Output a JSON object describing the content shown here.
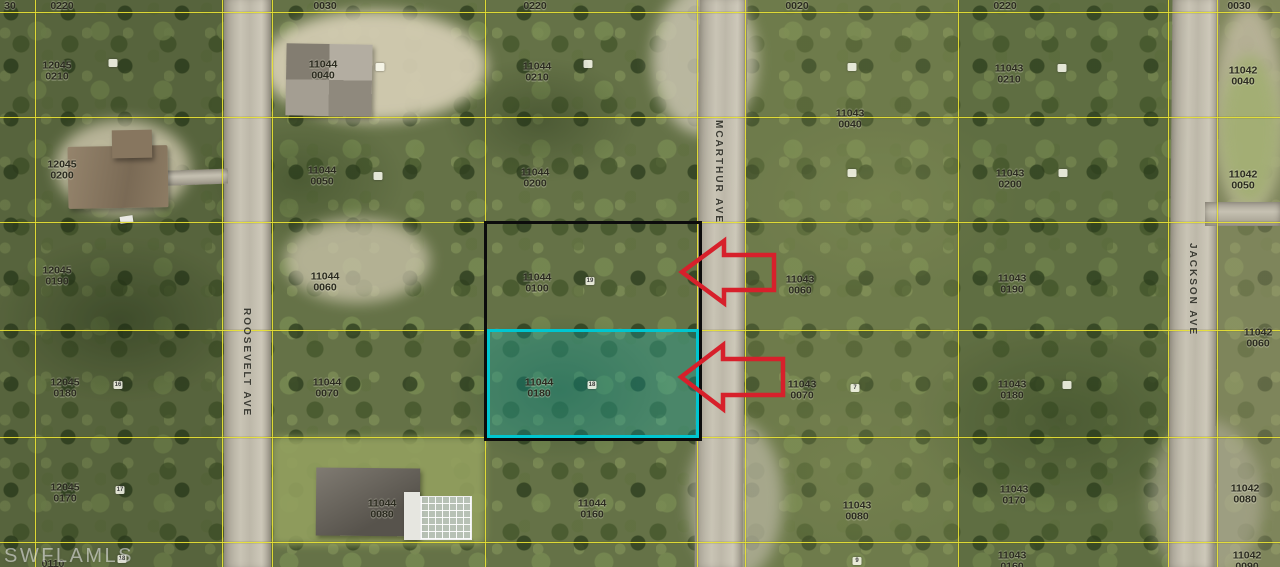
{
  "watermark": {
    "text": "SWFLAMLS"
  },
  "streets": [
    {
      "name": "ROOSEVELT AVE"
    },
    {
      "name": "MCARTHUR AVE"
    },
    {
      "name": "JACKSON AVE"
    }
  ],
  "parcels": [
    {
      "line1": "30",
      "line2": ""
    },
    {
      "line1": "0220",
      "line2": ""
    },
    {
      "line1": "12045",
      "line2": "0210"
    },
    {
      "line1": "12045",
      "line2": "0200"
    },
    {
      "line1": "12045",
      "line2": "0190"
    },
    {
      "line1": "12045",
      "line2": "0180"
    },
    {
      "line1": "12045",
      "line2": "0170"
    },
    {
      "line1": "0110",
      "line2": ""
    },
    {
      "line1": "0030",
      "line2": ""
    },
    {
      "line1": "11044",
      "line2": "0040"
    },
    {
      "line1": "11044",
      "line2": "0050"
    },
    {
      "line1": "11044",
      "line2": "0060"
    },
    {
      "line1": "11044",
      "line2": "0070"
    },
    {
      "line1": "11044",
      "line2": "0080"
    },
    {
      "line1": "0220",
      "line2": ""
    },
    {
      "line1": "11044",
      "line2": "0210"
    },
    {
      "line1": "11044",
      "line2": "0200"
    },
    {
      "line1": "11044",
      "line2": "0100"
    },
    {
      "line1": "11044",
      "line2": "0180"
    },
    {
      "line1": "11044",
      "line2": "0160"
    },
    {
      "line1": "0020",
      "line2": ""
    },
    {
      "line1": "11043",
      "line2": "0040"
    },
    {
      "line1": "11043",
      "line2": "0060"
    },
    {
      "line1": "11043",
      "line2": "0070"
    },
    {
      "line1": "11043",
      "line2": "0080"
    },
    {
      "line1": "0220",
      "line2": ""
    },
    {
      "line1": "11043",
      "line2": "0210"
    },
    {
      "line1": "11043",
      "line2": "0200"
    },
    {
      "line1": "11043",
      "line2": "0190"
    },
    {
      "line1": "11043",
      "line2": "0180"
    },
    {
      "line1": "11043",
      "line2": "0170"
    },
    {
      "line1": "11043",
      "line2": "0160"
    },
    {
      "line1": "0030",
      "line2": ""
    },
    {
      "line1": "11042",
      "line2": "0040"
    },
    {
      "line1": "11042",
      "line2": "0050"
    },
    {
      "line1": "11042",
      "line2": "0060"
    },
    {
      "line1": "11042",
      "line2": "0080"
    },
    {
      "line1": "11042",
      "line2": "0090"
    }
  ],
  "lot_markers": [
    {
      "text": "16"
    },
    {
      "text": "17"
    },
    {
      "text": "18"
    },
    {
      "text": "19"
    },
    {
      "text": "18"
    },
    {
      "text": "7"
    },
    {
      "text": "9"
    },
    {
      "text": ""
    },
    {
      "text": ""
    },
    {
      "text": ""
    },
    {
      "text": ""
    },
    {
      "text": ""
    },
    {
      "text": ""
    },
    {
      "text": ""
    },
    {
      "text": ""
    },
    {
      "text": ""
    }
  ],
  "colors": {
    "boundary_yellow": "#e8e234",
    "highlight_cyan": "#00c6d0",
    "outline_black": "#0c0c0c",
    "arrow_red": "#d7202b",
    "road_gray": "#bdb8a9",
    "foliage_green": "#657247"
  }
}
